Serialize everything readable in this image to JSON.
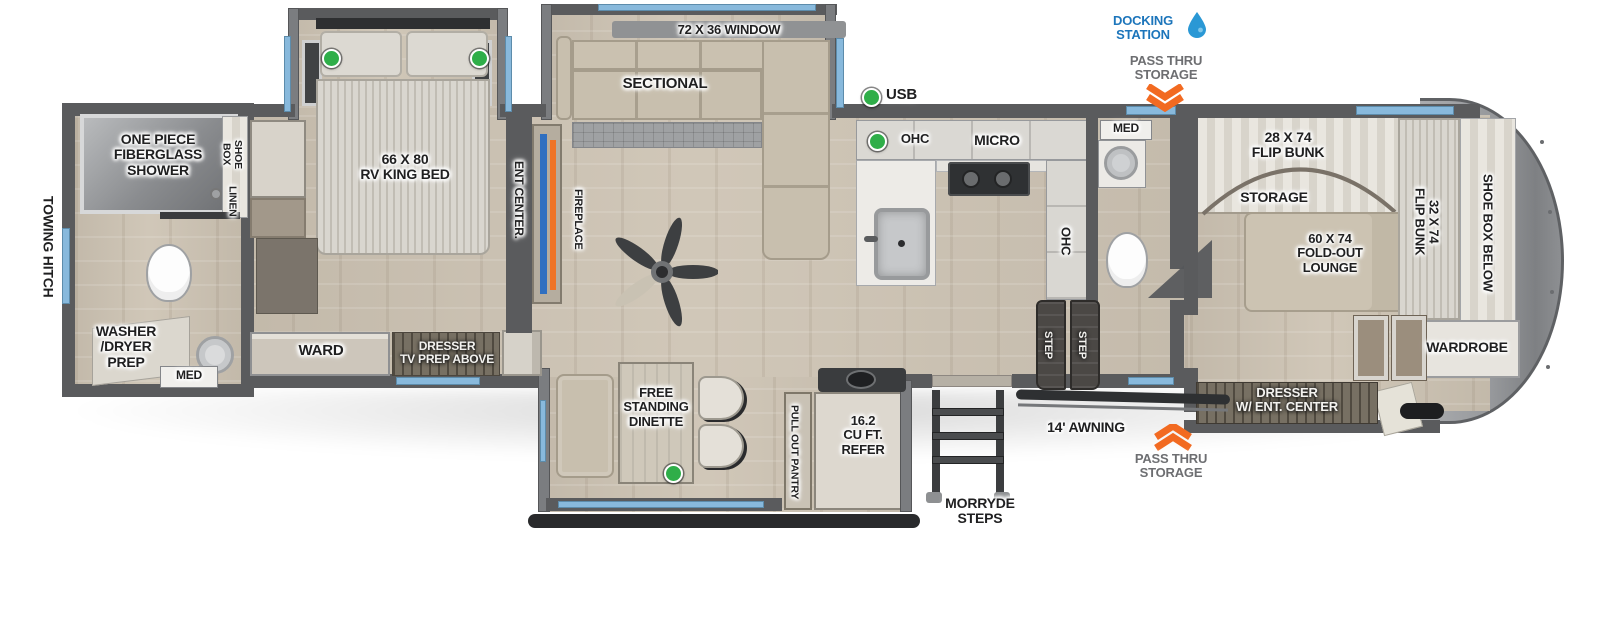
{
  "legend": {
    "usb_label": "USB"
  },
  "callouts": {
    "docking_station": "DOCKING\nSTATION",
    "pass_thru_top": "PASS THRU\nSTORAGE",
    "pass_thru_bottom": "PASS THRU\nSTORAGE",
    "awning": "14' AWNING",
    "morryde_steps": "MORRYDE\nSTEPS",
    "towing_hitch": "TOWING HITCH"
  },
  "rear_bath": {
    "shower": "ONE PIECE\nFIBERGLASS\nSHOWER",
    "shoe_box": "SHOE\nBOX",
    "linen": "LINEN",
    "washer_dryer_prep": "WASHER\n/DRYER\nPREP",
    "med": "MED"
  },
  "bedroom": {
    "king_bed": "66 X 80\nRV KING BED",
    "ward": "WARD",
    "dresser_tv": "DRESSER\nTV PREP ABOVE",
    "ent_center": "ENT CENTER."
  },
  "living_room": {
    "window": "72 X 36 WINDOW",
    "sectional": "SECTIONAL",
    "fireplace": "FIREPLACE"
  },
  "kitchen": {
    "ohc_top": "OHC",
    "micro": "MICRO",
    "ohc_side": "OHC",
    "step_left": "STEP",
    "step_right": "STEP"
  },
  "mid_bath": {
    "med": "MED"
  },
  "dinette": {
    "free_standing_dinette": "FREE\nSTANDING\nDINETTE",
    "pull_out_pantry": "PULL OUT PANTRY",
    "refer": "16.2\nCU FT.\nREFER"
  },
  "front_bunk_room": {
    "flip_bunk_28": "28 X 74\nFLIP BUNK",
    "storage": "STORAGE",
    "fold_out_lounge": "60 X 74\nFOLD-OUT\nLOUNGE",
    "flip_bunk_32": "32 X 74\nFLIP BUNK",
    "shoe_box_below": "SHOE BOX BELOW",
    "wardrobe": "WARDROBE",
    "dresser_ent_center": "DRESSER\nW/ ENT. CENTER"
  },
  "colors": {
    "wall": "#5a5b5d",
    "floor": "#cdc3b3",
    "window_blue": "#88b9dc",
    "accent_orange": "#f26a21",
    "docking_blue": "#1c75bb",
    "usb_green": "#2fae49",
    "tv_blue": "#2f6fc0",
    "label_gray": "#6d6e71"
  }
}
